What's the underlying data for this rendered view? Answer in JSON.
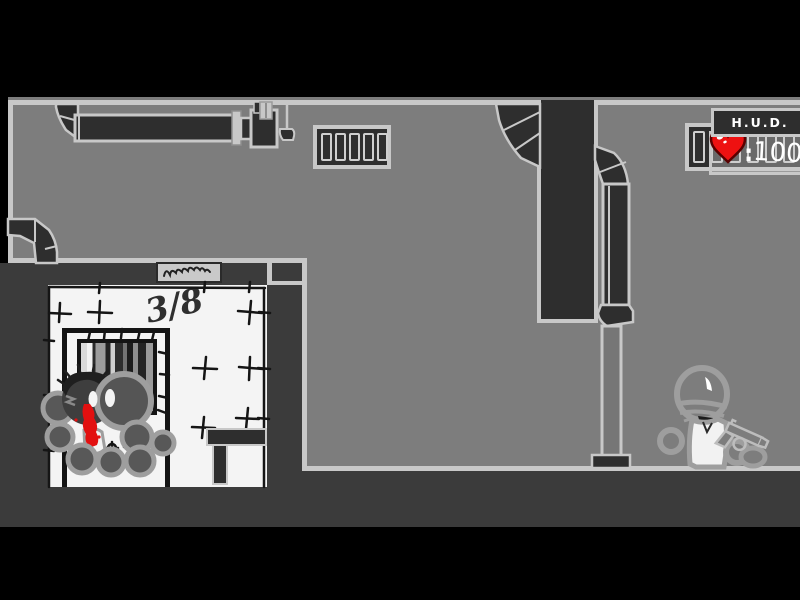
{
  "hud": {
    "title": "H.U.D.",
    "health_separator": ":",
    "health_value": "100",
    "heart_icon": "heart-health-icon",
    "heart_color": "#ee1111"
  },
  "wall_markings": {
    "counter": "3/8"
  },
  "icons": {
    "heart": "red heart with white glint",
    "sign_scribble": "illegible cursive scribble plaque",
    "wall_vent": "slatted air vent",
    "duct": "dark segmented air duct",
    "pipe": "vertical wall pipe",
    "cell_window": "barred cell-door window",
    "crowd": "pile of round-headed figures, one bloodied",
    "enemy": "helmeted figure in white vest holding pistol"
  },
  "palette": {
    "background_gray": "#7d7d7d",
    "outline_light": "#c8c8c8",
    "structure_dark": "#2e2e2e",
    "foreground_block": "#3b3b3b",
    "room_white": "#f4f4f4",
    "blood_red": "#e21010",
    "frame_black": "#000000"
  }
}
